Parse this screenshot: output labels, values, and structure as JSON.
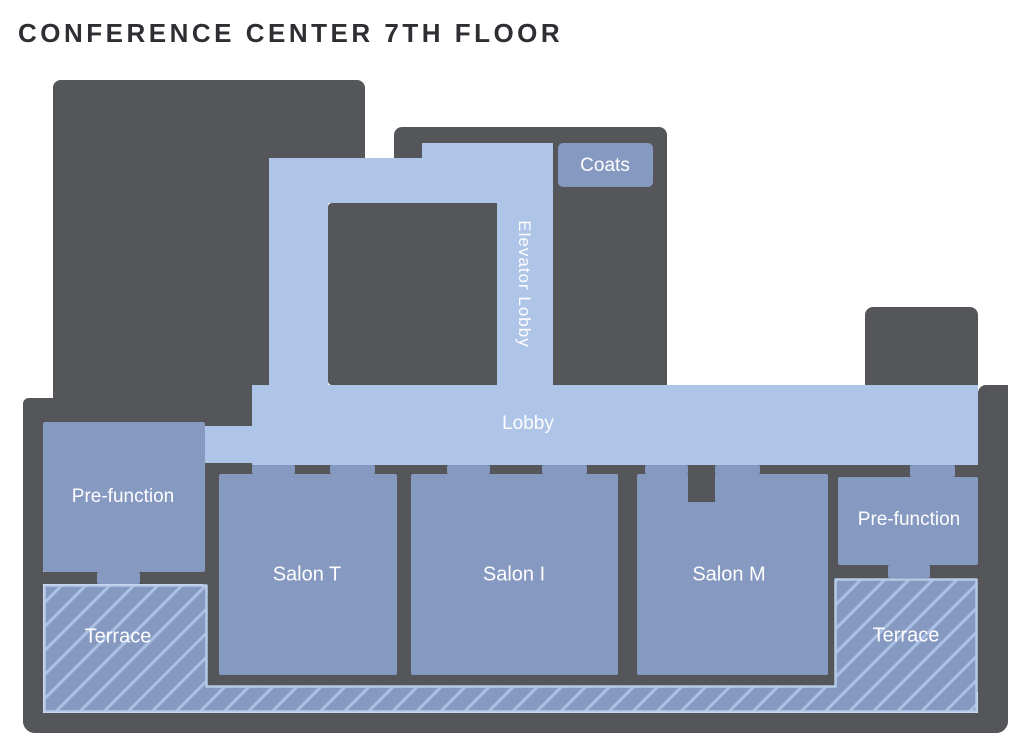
{
  "title": "CONFERENCE CENTER 7TH FLOOR",
  "rooms": {
    "coats": "Coats",
    "elevator_lobby": "Elevator Lobby",
    "lobby": "Lobby",
    "prefunction_left": "Pre-function",
    "prefunction_right": "Pre-function",
    "salon_t": "Salon T",
    "salon_i": "Salon I",
    "salon_m": "Salon M",
    "terrace_left": "Terrace",
    "terrace_right": "Terrace"
  },
  "colors": {
    "wall": "#55565a",
    "circulation": "#aec5e7",
    "room": "#8699c1",
    "hatch_line": "#aac1e4",
    "terrace_border": "#b7cae9",
    "title_text": "#2e2f33",
    "label_text": "#fdfdfe"
  }
}
